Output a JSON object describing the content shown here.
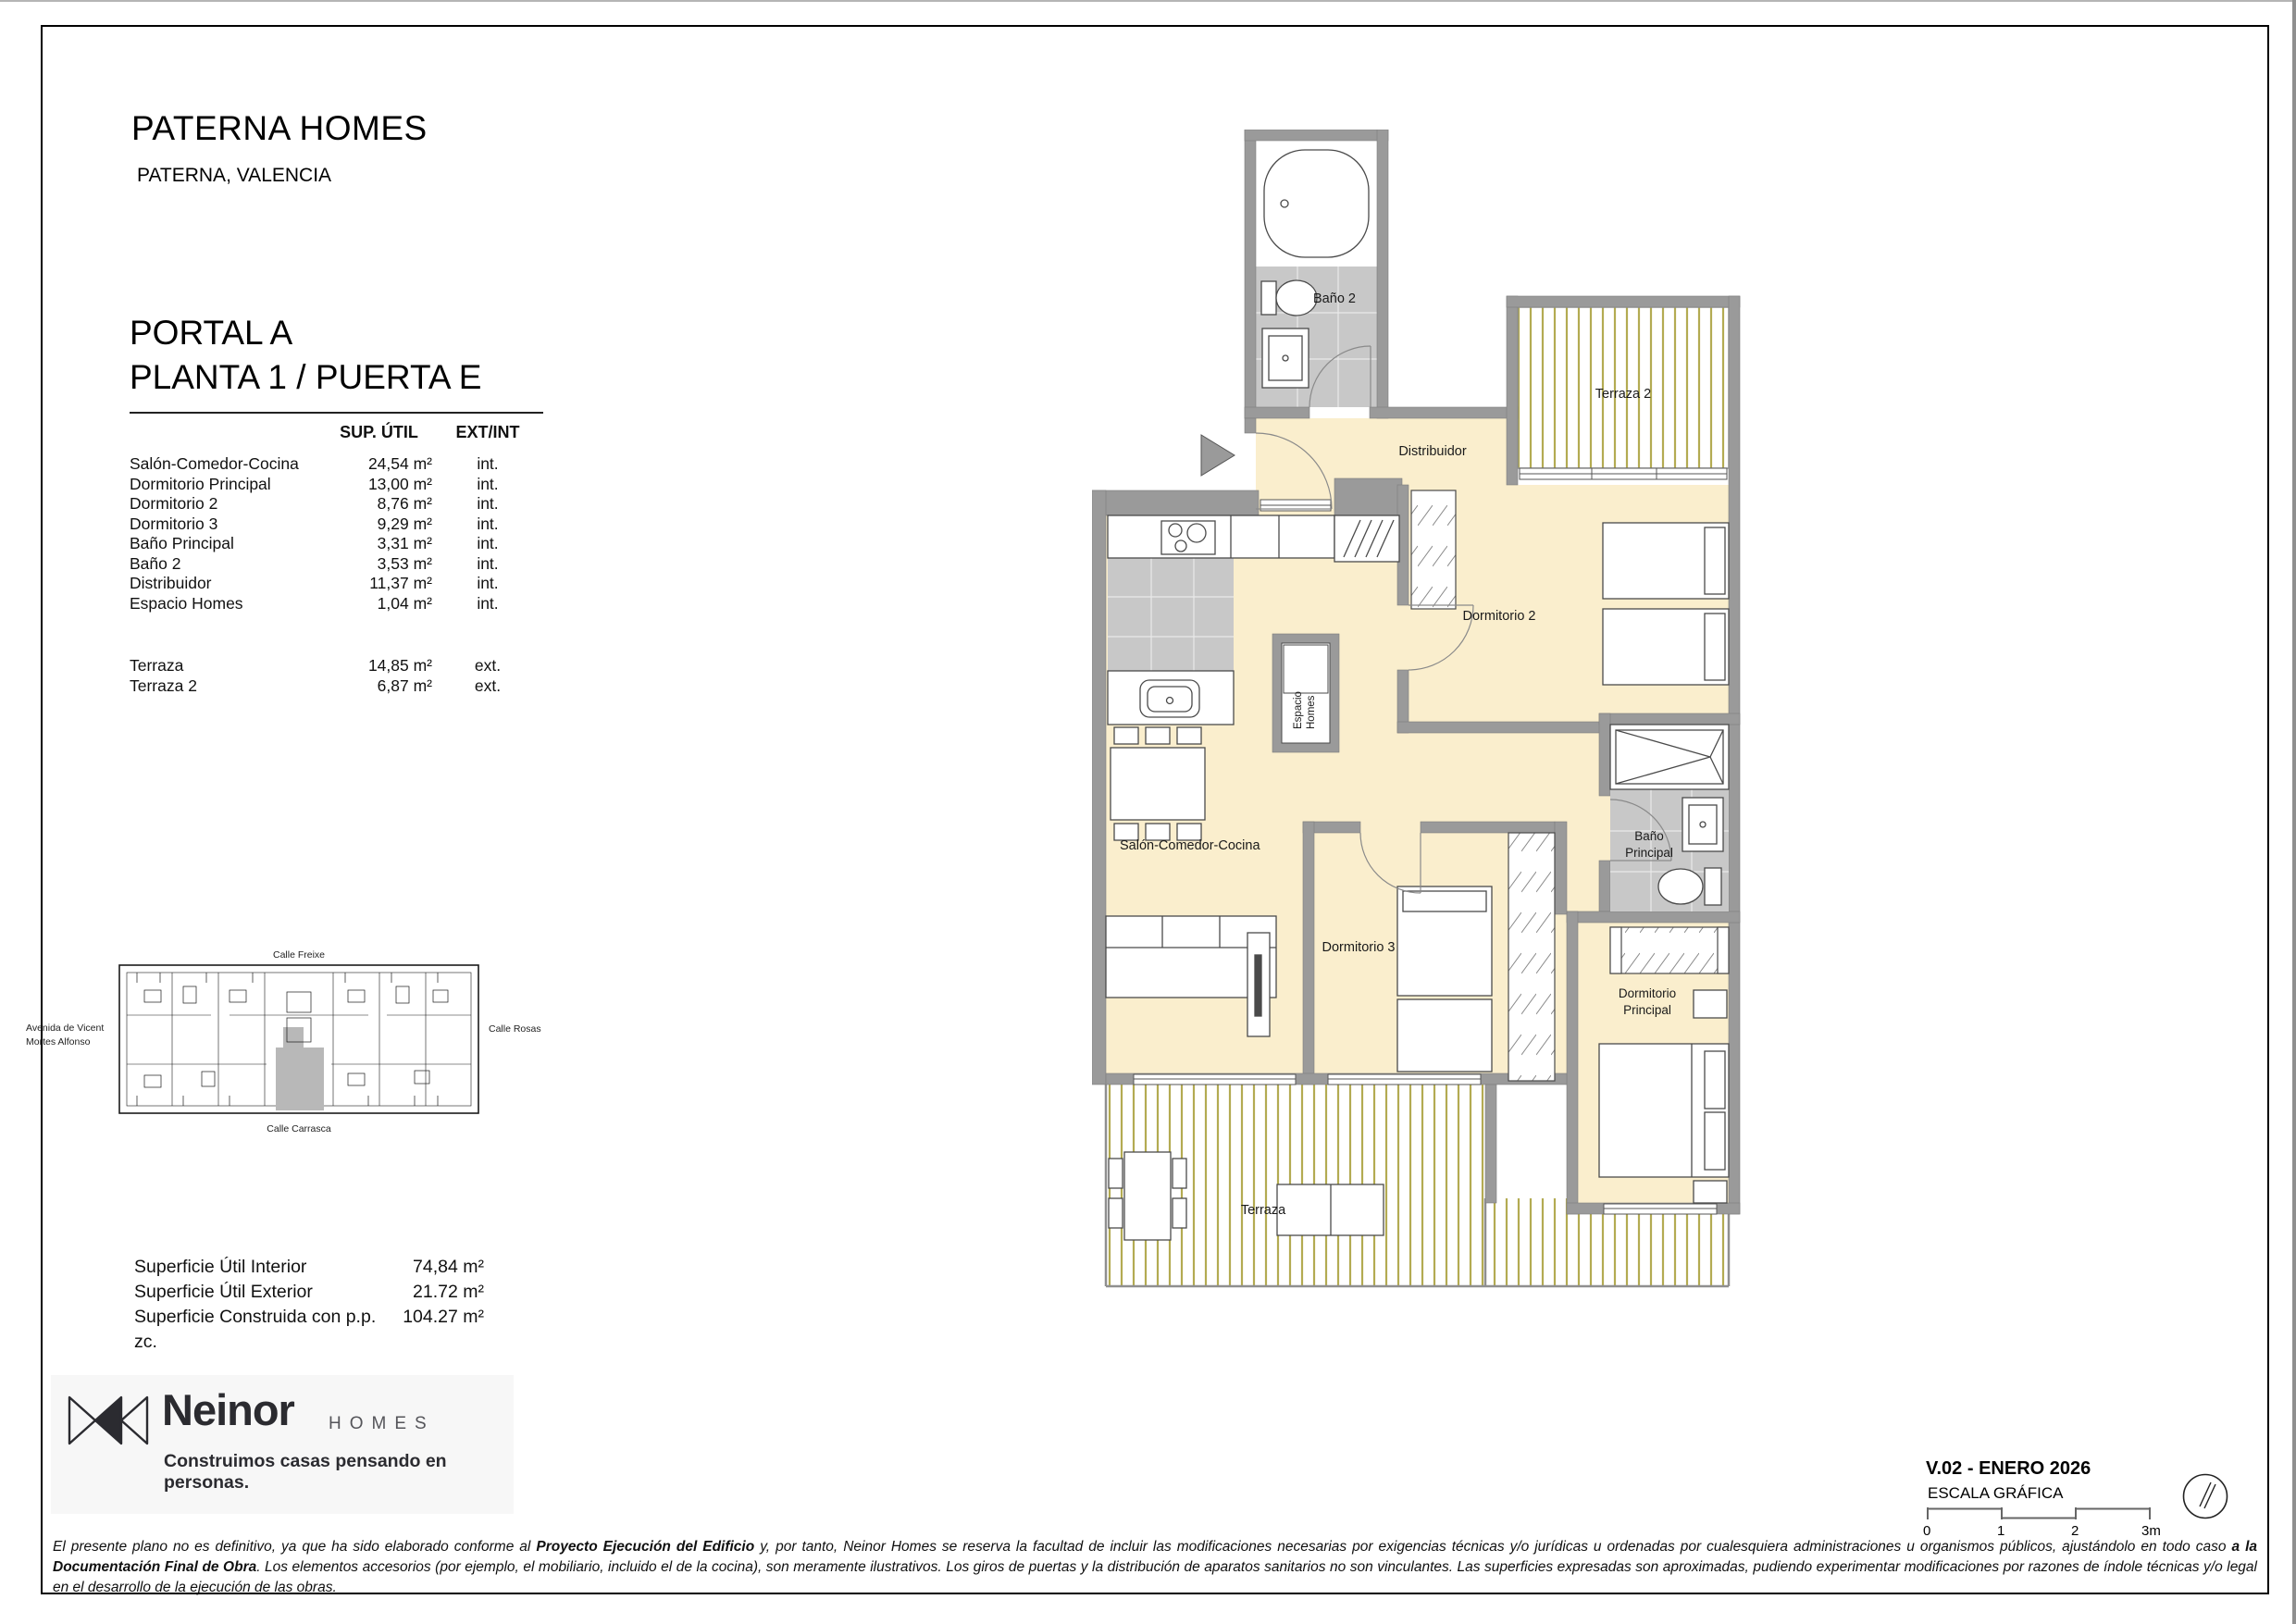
{
  "header": {
    "title": "PATERNA HOMES",
    "subtitle": "PATERNA, VALENCIA",
    "unit_line1": "PORTAL A",
    "unit_line2": "PLANTA 1 / PUERTA E"
  },
  "areas_table": {
    "col_area": "SUP. ÚTIL",
    "col_type": "EXT/INT",
    "interior_rows": [
      {
        "name": "Salón-Comedor-Cocina",
        "area": "24,54 m²",
        "type": "int."
      },
      {
        "name": "Dormitorio Principal",
        "area": "13,00 m²",
        "type": "int."
      },
      {
        "name": "Dormitorio 2",
        "area": "8,76 m²",
        "type": "int."
      },
      {
        "name": "Dormitorio 3",
        "area": "9,29 m²",
        "type": "int."
      },
      {
        "name": "Baño Principal",
        "area": "3,31 m²",
        "type": "int."
      },
      {
        "name": "Baño 2",
        "area": "3,53 m²",
        "type": "int."
      },
      {
        "name": "Distribuidor",
        "area": "11,37 m²",
        "type": "int."
      },
      {
        "name": "Espacio Homes",
        "area": "1,04 m²",
        "type": "int."
      }
    ],
    "exterior_rows": [
      {
        "name": "Terraza",
        "area": "14,85 m²",
        "type": "ext."
      },
      {
        "name": "Terraza 2",
        "area": "6,87 m²",
        "type": "ext."
      }
    ]
  },
  "site_map": {
    "street_top": "Calle Freixe",
    "street_left_line1": "Avenida de Vicent",
    "street_left_line2": "Mortes Alfonso",
    "street_right": "Calle Rosas",
    "street_bottom": "Calle Carrasca"
  },
  "summary": {
    "rows": [
      {
        "label": "Superficie Útil Interior",
        "value": "74,84 m²"
      },
      {
        "label": "Superficie Útil Exterior",
        "value": "21.72 m²"
      },
      {
        "label": "Superficie Construida con p.p. zc.",
        "value": "104.27 m²"
      }
    ]
  },
  "brand": {
    "name": "Neinor",
    "suffix": "HOMES",
    "tagline": "Construimos casas pensando en personas."
  },
  "plan": {
    "labels": {
      "banyo2": "Baño 2",
      "terraza2": "Terraza 2",
      "distribuidor": "Distribuidor",
      "salon": "Salón-Comedor-Cocina",
      "dorm2": "Dormitorio 2",
      "espacio_line1": "Espacio",
      "espacio_line2": "Homes",
      "banyo_ppal_line1": "Baño",
      "banyo_ppal_line2": "Principal",
      "dorm3": "Dormitorio 3",
      "dorm_ppal_line1": "Dormitorio",
      "dorm_ppal_line2": "Principal",
      "terraza": "Terraza"
    },
    "colors": {
      "wall": "#9a9a9a",
      "floor": "#faeecd",
      "tile": "#c8c8c8",
      "terrace_stripe": "#b3ab52"
    }
  },
  "footer": {
    "version": "V.02 - ENERO 2026",
    "scale_label": "ESCALA GRÁFICA",
    "scale_ticks": [
      "0",
      "1",
      "2",
      "3m"
    ]
  },
  "disclaimer": {
    "segments": [
      {
        "t": "El presente plano no es definitivo, ya que ha sido elaborado conforme al ",
        "b": false
      },
      {
        "t": "Proyecto Ejecución del Edificio",
        "b": true
      },
      {
        "t": " y, por tanto, Neinor Homes se reserva la facultad de incluir las modificaciones necesarias por exigencias técnicas y/o jurídicas u ordenadas por cualesquiera administraciones u organismos públicos, ajustándolo en todo caso ",
        "b": false
      },
      {
        "t": "a la Documentación Final de Obra",
        "b": true
      },
      {
        "t": ". Los elementos accesorios (por ejemplo, el mobiliario, incluido el de la cocina), son meramente ilustrativos. Los giros de puertas y la distribución de aparatos sanitarios no son vinculantes. Las superficies expresadas son aproximadas, pudiendo experimentar modificaciones por razones de índole técnicas y/o legal en el desarrollo de la ejecución de las obras.",
        "b": false
      }
    ]
  }
}
